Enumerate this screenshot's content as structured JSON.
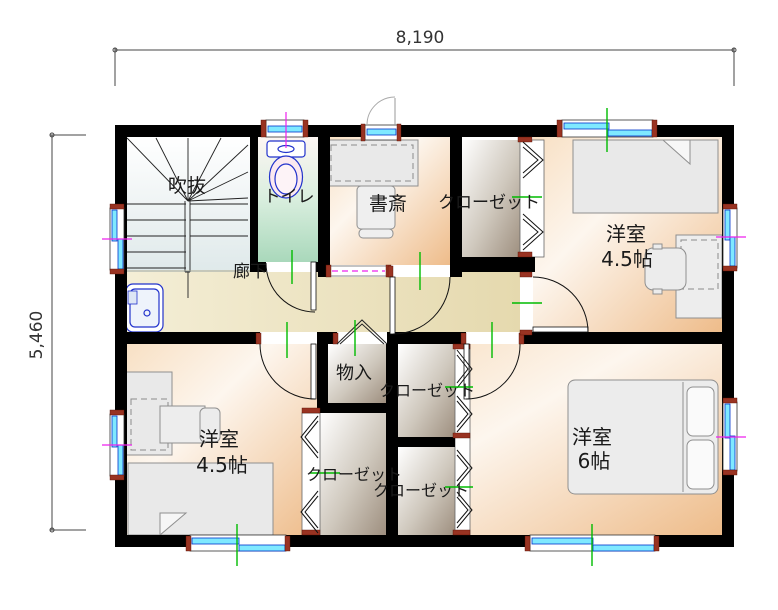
{
  "dimensions": {
    "width_label": "8,190",
    "height_label": "5,460"
  },
  "rooms": {
    "void": {
      "label": "吹抜"
    },
    "toilet": {
      "label": "トイレ"
    },
    "study": {
      "label": "書斎"
    },
    "closet_top": {
      "label": "クローゼット"
    },
    "bedroom_ne": {
      "name": "洋室",
      "size": "4.5帖"
    },
    "hallway": {
      "label": "廊下"
    },
    "storage": {
      "label": "物入"
    },
    "closet_mid": {
      "label": "クローゼット"
    },
    "closet_sw": {
      "label": "クローゼット"
    },
    "closet_se": {
      "label": "クローゼット"
    },
    "bedroom_sw": {
      "name": "洋室",
      "size": "4.5帖"
    },
    "bedroom_se": {
      "name": "洋室",
      "size": "6帖"
    }
  },
  "colors": {
    "wall": "#000000",
    "window_glass": "#7fe9ff",
    "window_frame": "#0033cc",
    "fixture_blue": "#2233cc",
    "tick_green": "#00bb00",
    "tick_magenta": "#ee22ee",
    "jamb_red": "#993322",
    "floor_peach": "#eebc8a",
    "floor_tan": "#e5d9ae",
    "floor_mint": "#a9d8bb",
    "closet_gray": "#9e8f7f"
  }
}
